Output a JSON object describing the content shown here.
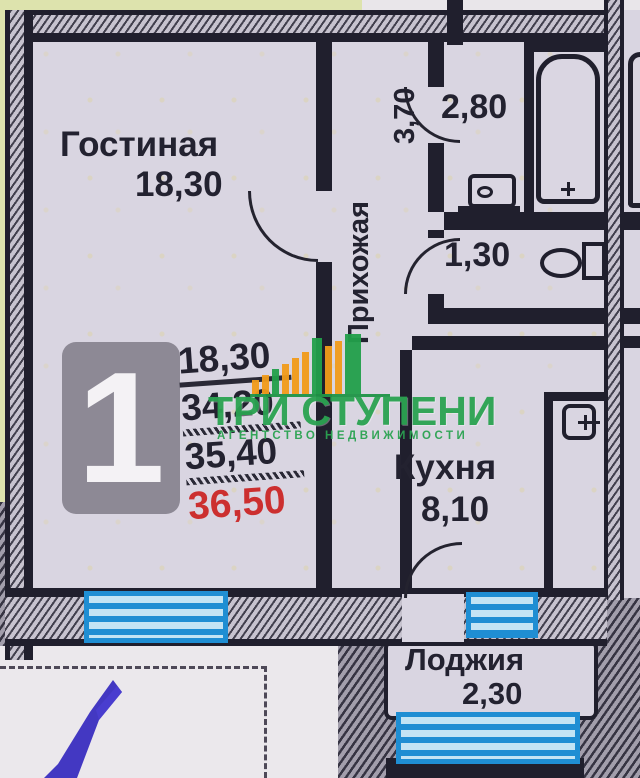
{
  "plan": {
    "rooms": {
      "living": {
        "name": "Гостиная",
        "area": "18,30"
      },
      "hall": {
        "name": "Прихожая",
        "area": "3,70"
      },
      "bath": {
        "area": "2,80"
      },
      "wc": {
        "area": "1,30"
      },
      "kitchen": {
        "name": "Кухня",
        "area": "8,10"
      },
      "loggia": {
        "name": "Лоджия",
        "area": "2,30"
      }
    },
    "fixtures": [
      "bathtub-icon",
      "sink-icon",
      "toilet-icon",
      "electric-panel-icon",
      "window-icon",
      "door-arc-icon"
    ]
  },
  "unit_card": {
    "rooms_badge": "1",
    "area_rows": [
      {
        "value": "18,30",
        "style": "plain-underline"
      },
      {
        "value": "34,20",
        "style": "hatch-underline"
      },
      {
        "value": "35,40",
        "style": "hatch-underline"
      },
      {
        "value": "36,50",
        "style": "total-red"
      }
    ]
  },
  "watermark": {
    "title": "ТРИ СТУПЕНИ",
    "subtitle": "АГЕНТСТВО  НЕДВИЖИМОСТИ"
  },
  "colors": {
    "wall": "#201f2d",
    "paper": "#d9d5e1",
    "outside_yellow": "#dde3ad",
    "window_blue": "#1f8ed3",
    "total_red": "#cc2f2f",
    "watermark_green": "#2ba351",
    "watermark_orange": "#f29c1a",
    "pen_blue": "#3a2ec0"
  }
}
